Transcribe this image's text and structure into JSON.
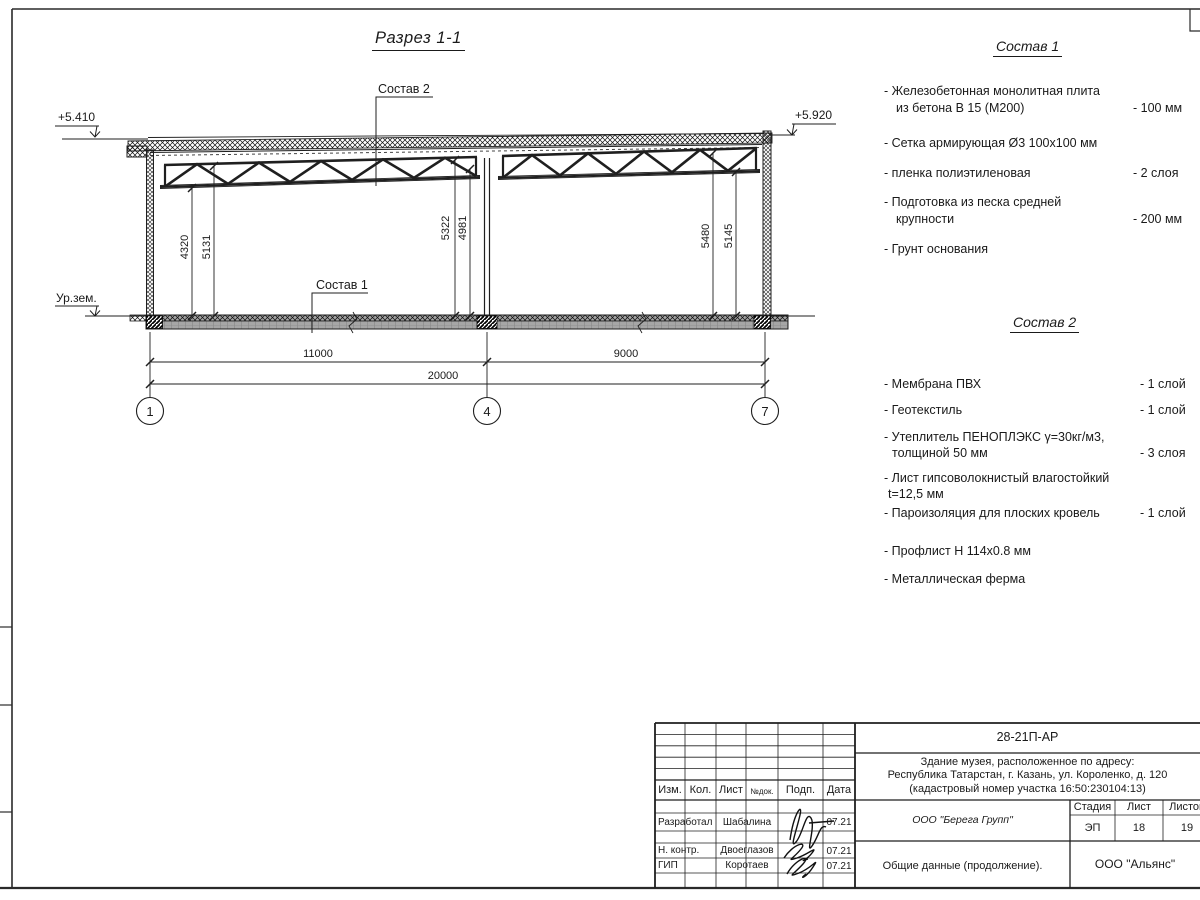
{
  "colors": {
    "line": "#1a1a1a",
    "floor_fill": "#a6a6a6",
    "paper": "#ffffff"
  },
  "drawing": {
    "title": "Разрез 1-1",
    "elev_left": "+5.410",
    "elev_right": "+5.920",
    "ground_label": "Ур.зем.",
    "leader_sostav1": "Состав 1",
    "leader_sostav2": "Состав 2",
    "dims_vertical": [
      "4320",
      "5131",
      "5322",
      "4981",
      "5480",
      "5145"
    ],
    "span1": "11000",
    "span2": "9000",
    "total": "20000",
    "axes": [
      "1",
      "4",
      "7"
    ]
  },
  "sostav1": {
    "title": "Состав 1",
    "items": [
      {
        "line1": "- Железобетонная  монолитная плита",
        "line2": "из бетона В 15 (М200)",
        "value": "- 100 мм"
      },
      {
        "line1": "- Сетка армирующая Ø3 100х100 мм",
        "line2": "",
        "value": ""
      },
      {
        "line1": "- пленка полиэтиленовая",
        "line2": "",
        "value": "- 2  слоя"
      },
      {
        "line1": "- Подготовка из песка средней",
        "line2": "крупности",
        "value": "- 200 мм"
      },
      {
        "line1": "- Грунт основания",
        "line2": "",
        "value": ""
      }
    ]
  },
  "sostav2": {
    "title": "Состав 2",
    "items": [
      {
        "line1": "- Мембрана ПВХ",
        "line2": "",
        "value": "- 1 слой"
      },
      {
        "line1": "- Геотекстиль",
        "line2": "",
        "value": "- 1 слой"
      },
      {
        "line1": "- Утеплитель ПЕНОПЛЭКС γ=30кг/м3,",
        "line2": "толщиной 50 мм",
        "value": "- 3 слоя"
      },
      {
        "line1": "- Лист гипсоволокнистый влагостойкий",
        "line2": "t=12,5 мм",
        "value": ""
      },
      {
        "line1": "- Пароизоляция для плоских кровель",
        "line2": "",
        "value": "- 1 слой"
      },
      {
        "line1": "- Профлист Н 114х0.8 мм",
        "line2": "",
        "value": ""
      },
      {
        "line1": "- Металлическая ферма",
        "line2": "",
        "value": ""
      }
    ]
  },
  "titleblock": {
    "doc_number": "28-21П-АР",
    "project_line1": "Здание музея, расположенное по адресу:",
    "project_line2": "Республика Татарстан, г. Казань, ул. Короленко, д. 120",
    "project_line3": "(кадастровый номер участка 16:50:230104:13)",
    "col_izm": "Изм.",
    "col_kol": "Кол.",
    "col_list": "Лист",
    "col_ndok": "№док.",
    "col_podp": "Подп.",
    "col_data": "Дата",
    "rows": [
      {
        "role": "Разработал",
        "name": "Шабалина",
        "date": "07.21"
      },
      {
        "role": "Н. контр.",
        "name": "Двоеглазов",
        "date": "07.21"
      },
      {
        "role": "ГИП",
        "name": "Коротаев",
        "date": "07.21"
      }
    ],
    "org": "ООО \"Берега Групп\"",
    "stage_label": "Стадия",
    "sheet_label": "Лист",
    "sheets_label": "Листов",
    "stage": "ЭП",
    "sheet": "18",
    "sheets": "19",
    "doc_title": "Общие данные (продолжение).",
    "company": "ООО \"Альянс\""
  }
}
